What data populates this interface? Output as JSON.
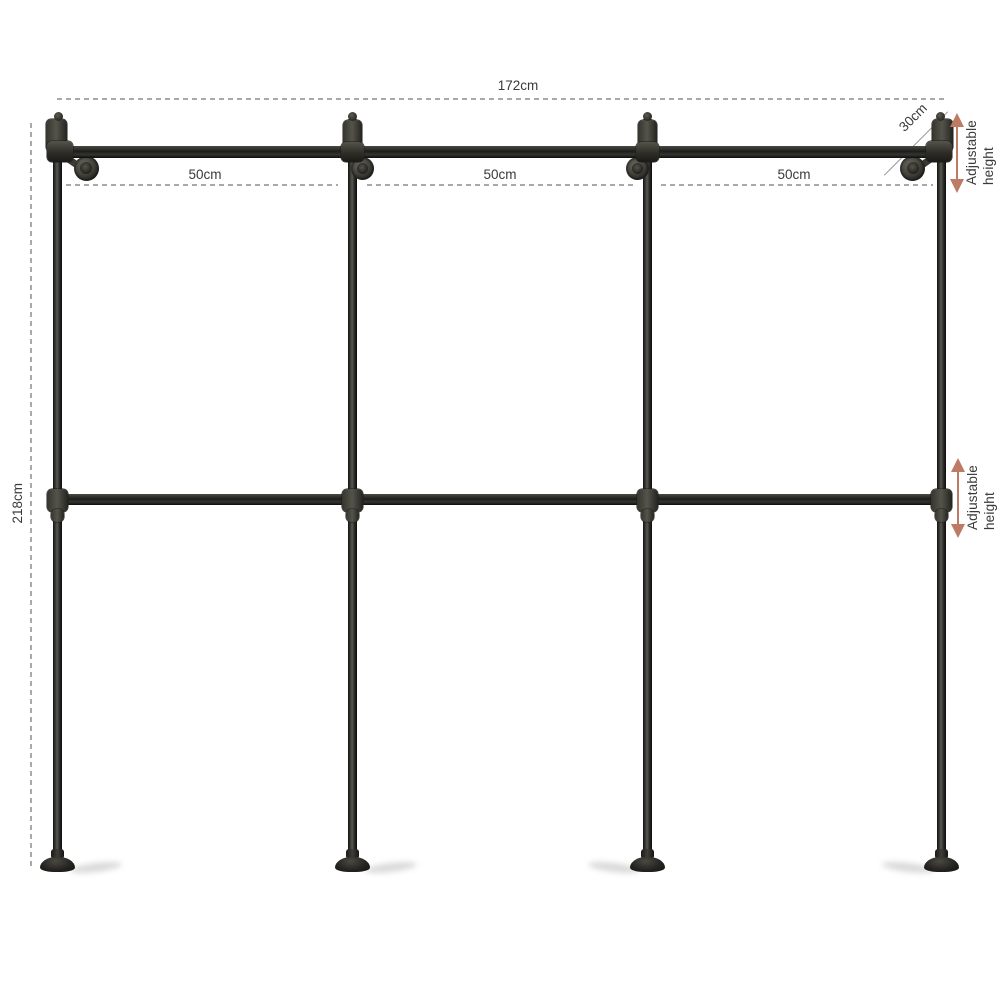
{
  "labels": {
    "width": "172cm",
    "height": "218cm",
    "depth": "30cm",
    "adjustable_line1": "Adjustable",
    "adjustable_line2": "height"
  },
  "sections": [
    {
      "label": "50cm"
    },
    {
      "label": "50cm"
    },
    {
      "label": "50cm"
    }
  ],
  "colors": {
    "arrow": "#bd7a64",
    "dim_line": "#a9a9a9",
    "text": "#3a3a3a",
    "pipe": "#23231f",
    "background": "#ffffff"
  }
}
